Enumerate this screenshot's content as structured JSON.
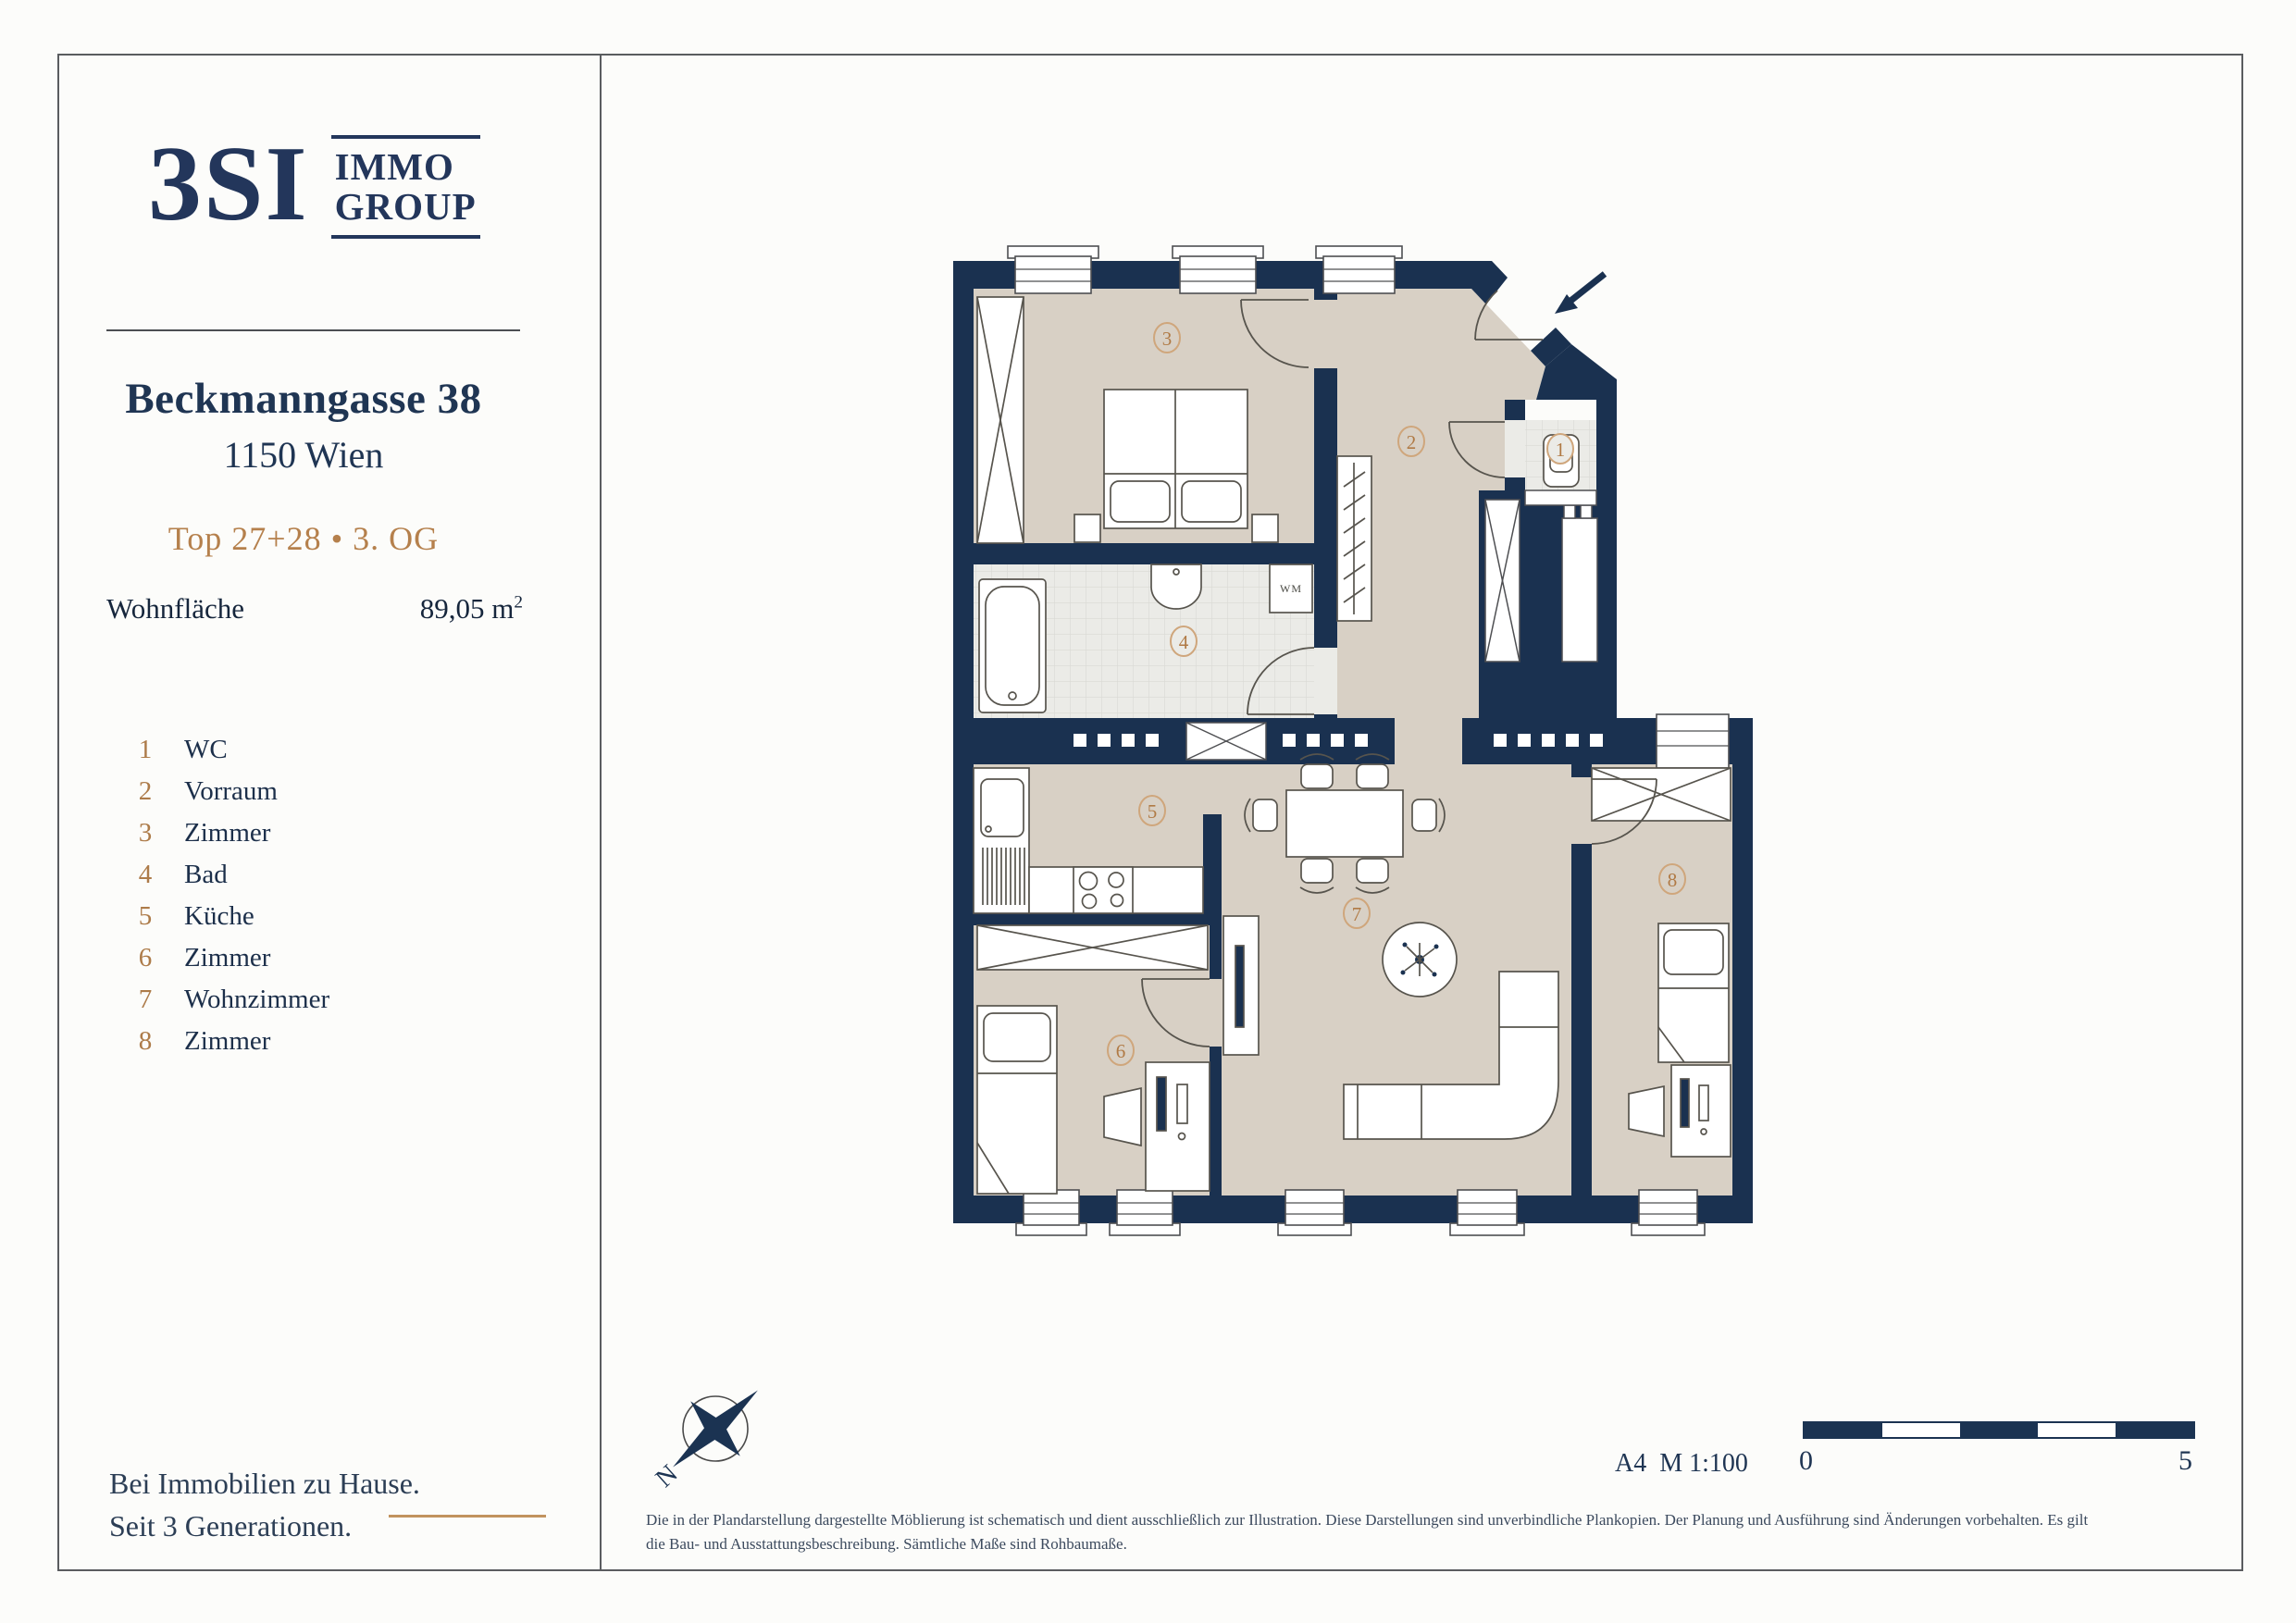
{
  "colors": {
    "navy": "#1b3352",
    "wall": "#1a3150",
    "bronze": "#b5804c",
    "floor": "#d8d0c5",
    "tile": "#ebebe7",
    "frame_gray": "#5a5c5f"
  },
  "sidebar": {
    "logo": {
      "main": "3SI",
      "sub_top": "IMMO",
      "sub_bottom": "GROUP"
    },
    "address_line1": "Beckmanngasse 38",
    "address_line2": "1150 Wien",
    "unit_line": "Top 27+28 • 3. OG",
    "area_label": "Wohnfläche",
    "area_value": "89,05 m",
    "area_sup": "2",
    "legend": [
      {
        "num": "1",
        "label": "WC"
      },
      {
        "num": "2",
        "label": "Vorraum"
      },
      {
        "num": "3",
        "label": "Zimmer"
      },
      {
        "num": "4",
        "label": "Bad"
      },
      {
        "num": "5",
        "label": "Küche"
      },
      {
        "num": "6",
        "label": "Zimmer"
      },
      {
        "num": "7",
        "label": "Wohnzimmer"
      },
      {
        "num": "8",
        "label": "Zimmer"
      }
    ],
    "tagline_line1": "Bei Immobilien zu Hause.",
    "tagline_line2": "Seit 3 Generationen."
  },
  "plan": {
    "rooms": {
      "r1": "1",
      "r2": "2",
      "r3": "3",
      "r4": "4",
      "r5": "5",
      "r6": "6",
      "r7": "7",
      "r8": "8"
    },
    "wm_label": "WM",
    "compass_label": "N"
  },
  "footer": {
    "scale_label": "A4  M 1:100",
    "scalebar_start": "0",
    "scalebar_end": "5",
    "disclaimer": "Die in der Plandarstellung dargestellte Möblierung ist schematisch und dient ausschließlich zur Illustration. Diese Darstellungen sind unverbindliche Plankopien. Der Planung und Ausführung sind Änderungen vorbehalten. Es gilt die Bau- und Ausstattungsbeschreibung. Sämtliche Maße sind Rohbaumaße."
  }
}
